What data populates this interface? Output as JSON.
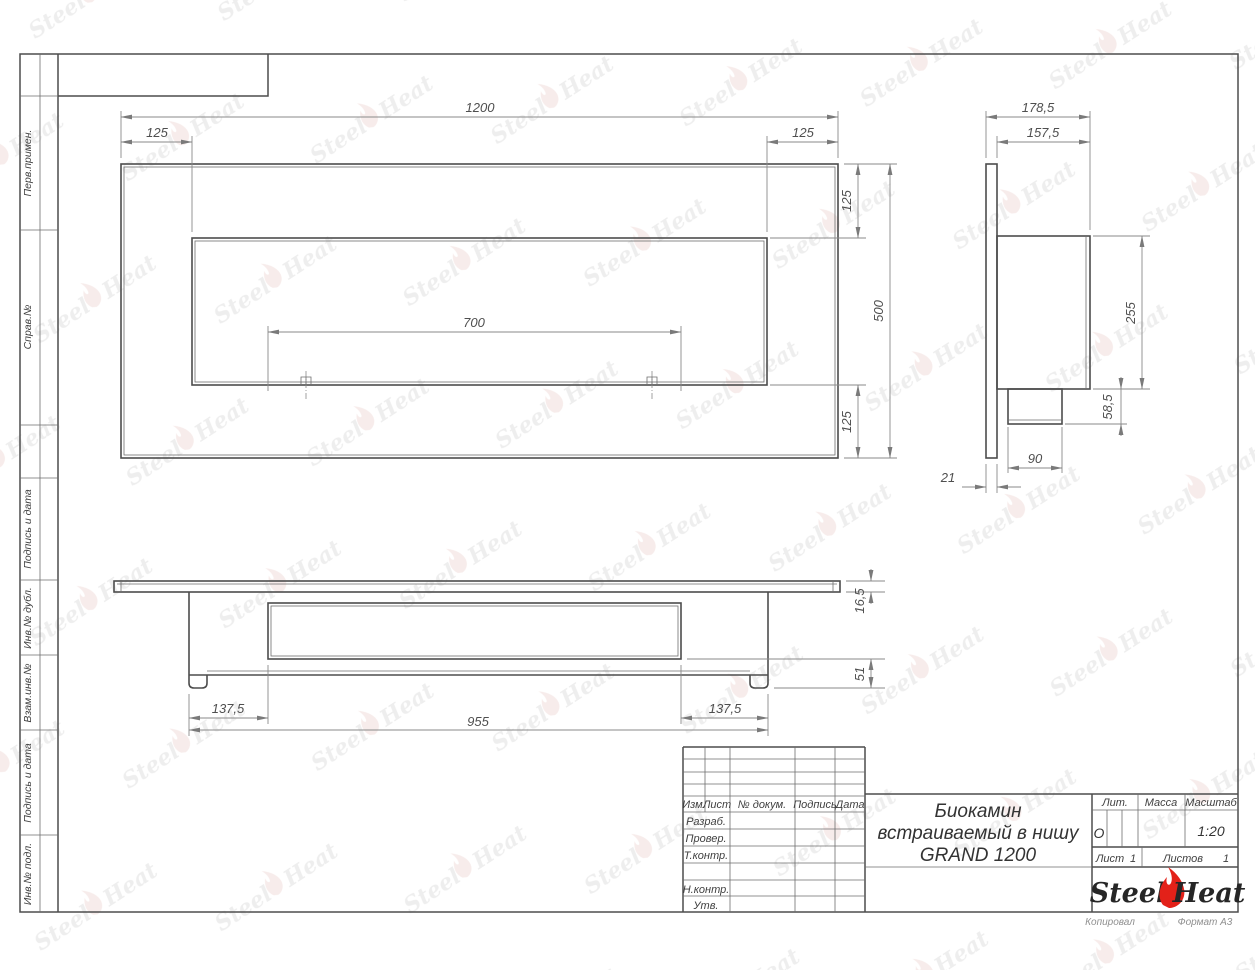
{
  "page": {
    "copied_label": "Копировал",
    "format_label": "Формат А3"
  },
  "colors": {
    "flame_red": "#e32119",
    "line_gray": "#4d4d4d"
  },
  "watermark": {
    "steel": "Steel",
    "heat": "Heat"
  },
  "sidebar": {
    "perv_primen": "Перв.примен.",
    "sprav_no": "Справ.№",
    "podpis_data_1": "Подпись и дата",
    "inv_dubl": "Инв.№ дубл.",
    "vzam_inv": "Взам.инв.№",
    "podpis_data_2": "Подпись и дата",
    "inv_podl": "Инв.№ подл."
  },
  "title_block": {
    "col_izm": "Изм.",
    "col_list": "Лист",
    "col_doc": "№ докум.",
    "col_sign": "Подпись",
    "col_date": "Дата",
    "row_razrab": "Разраб.",
    "row_prover": "Провер.",
    "row_tkontr": "Т.контр.",
    "row_nkontr": "Н.контр.",
    "row_utv": "Утв.",
    "title_line1": "Биокамин",
    "title_line2": "встраиваемый в нишу",
    "title_line3": "GRAND 1200",
    "lit_label": "Лит.",
    "lit_value": "О",
    "mass_label": "Масса",
    "scale_label": "Масштаб",
    "scale_value": "1:20",
    "sheet_label": "Лист",
    "sheet_value": "1",
    "sheets_label": "Листов",
    "sheets_value": "1",
    "logo_steel": "Steel",
    "logo_heat": "Heat"
  },
  "dimensions": {
    "front": {
      "width": "1200",
      "left_offset": "125",
      "right_offset": "125",
      "top_offset": "125",
      "height": "500",
      "bottom_offset": "125",
      "burner_span": "700"
    },
    "side": {
      "total_depth": "178,5",
      "body_depth": "157,5",
      "body_height": "255",
      "spout_height": "58,5",
      "spout_width": "90",
      "panel_thickness": "21"
    },
    "plan": {
      "flange_thickness": "16,5",
      "inner_depth": "51",
      "left_margin": "137,5",
      "body_width": "955",
      "right_margin": "137,5"
    }
  }
}
